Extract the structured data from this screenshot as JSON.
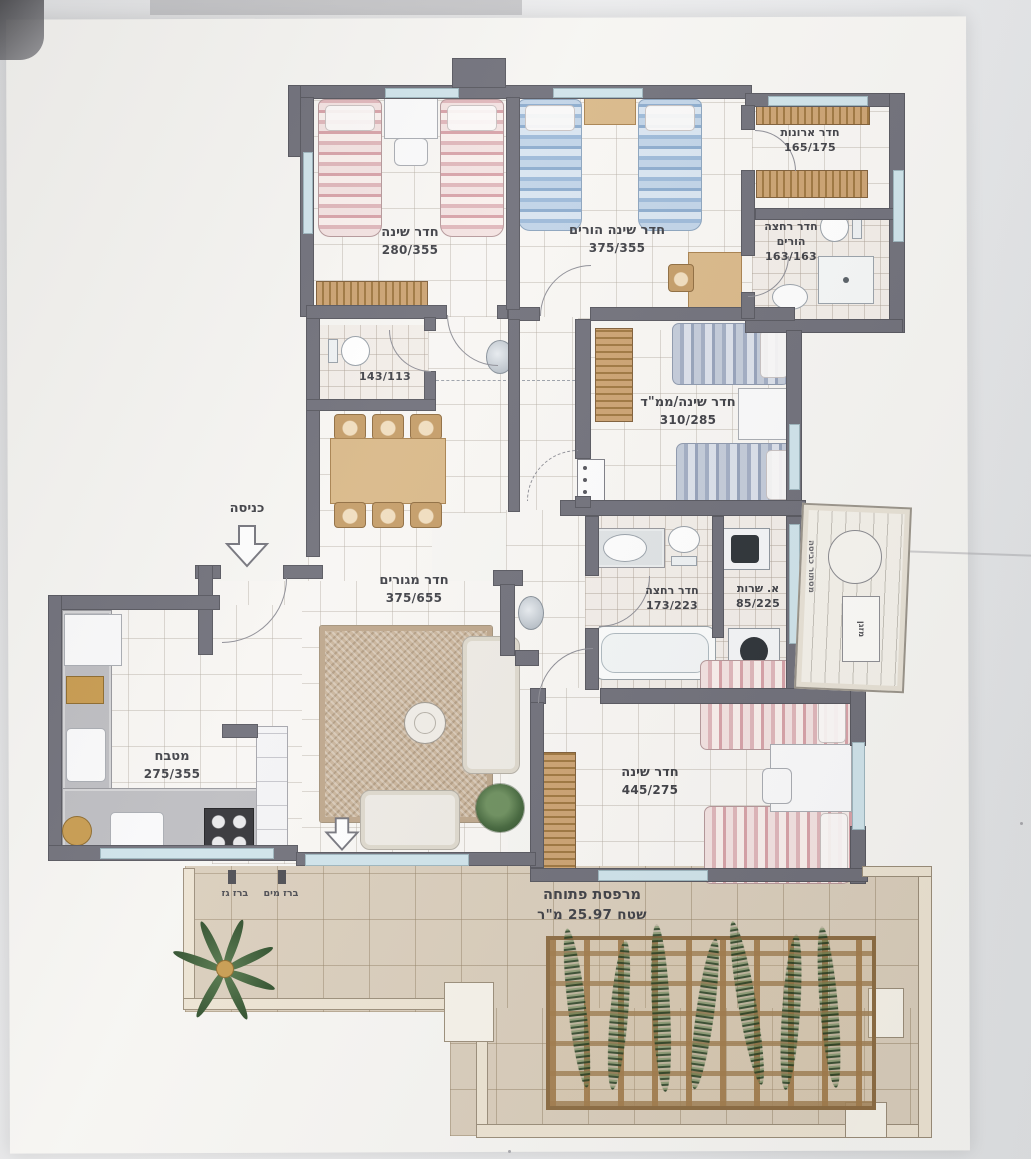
{
  "rooms": [
    {
      "name": "חדר שינה",
      "dims": "280/355"
    },
    {
      "name": "חדר שינה הורים",
      "dims": "375/355"
    },
    {
      "name": "חדר ארונות",
      "dims": "165/175"
    },
    {
      "name": "חדר רחצה",
      "name2": "הורים",
      "dims": "163/163"
    },
    {
      "name": "חדר שינה/ממ\"ד",
      "dims": "310/285"
    },
    {
      "name": "",
      "dims": "143/113"
    },
    {
      "name": "חדר מגורים",
      "dims": "375/655"
    },
    {
      "name": "חדר רחצה",
      "dims": "173/223"
    },
    {
      "name": "א. שרות",
      "dims": "85/225"
    },
    {
      "name": "מטבח",
      "dims": "275/355"
    },
    {
      "name": "חדר שינה",
      "dims": "445/275"
    },
    {
      "name": "מרפסת פתוחה",
      "dims": "שטח 25.97 מ\"ר"
    }
  ],
  "annotations": {
    "entrance": "כניסה",
    "water_tap": "ברז מים",
    "gas_tap": "ברז גז",
    "laundry_screen": "מסתור כביסה",
    "ac_unit": "מזגן"
  },
  "colors": {
    "wall": "#70707a",
    "window": "#cfe3ea",
    "wood": "#c49a66",
    "stone": "#d9cdbb",
    "pink_bed": "#e8c6ca",
    "blue_bed": "#a9c4de",
    "text": "#3f4046"
  }
}
